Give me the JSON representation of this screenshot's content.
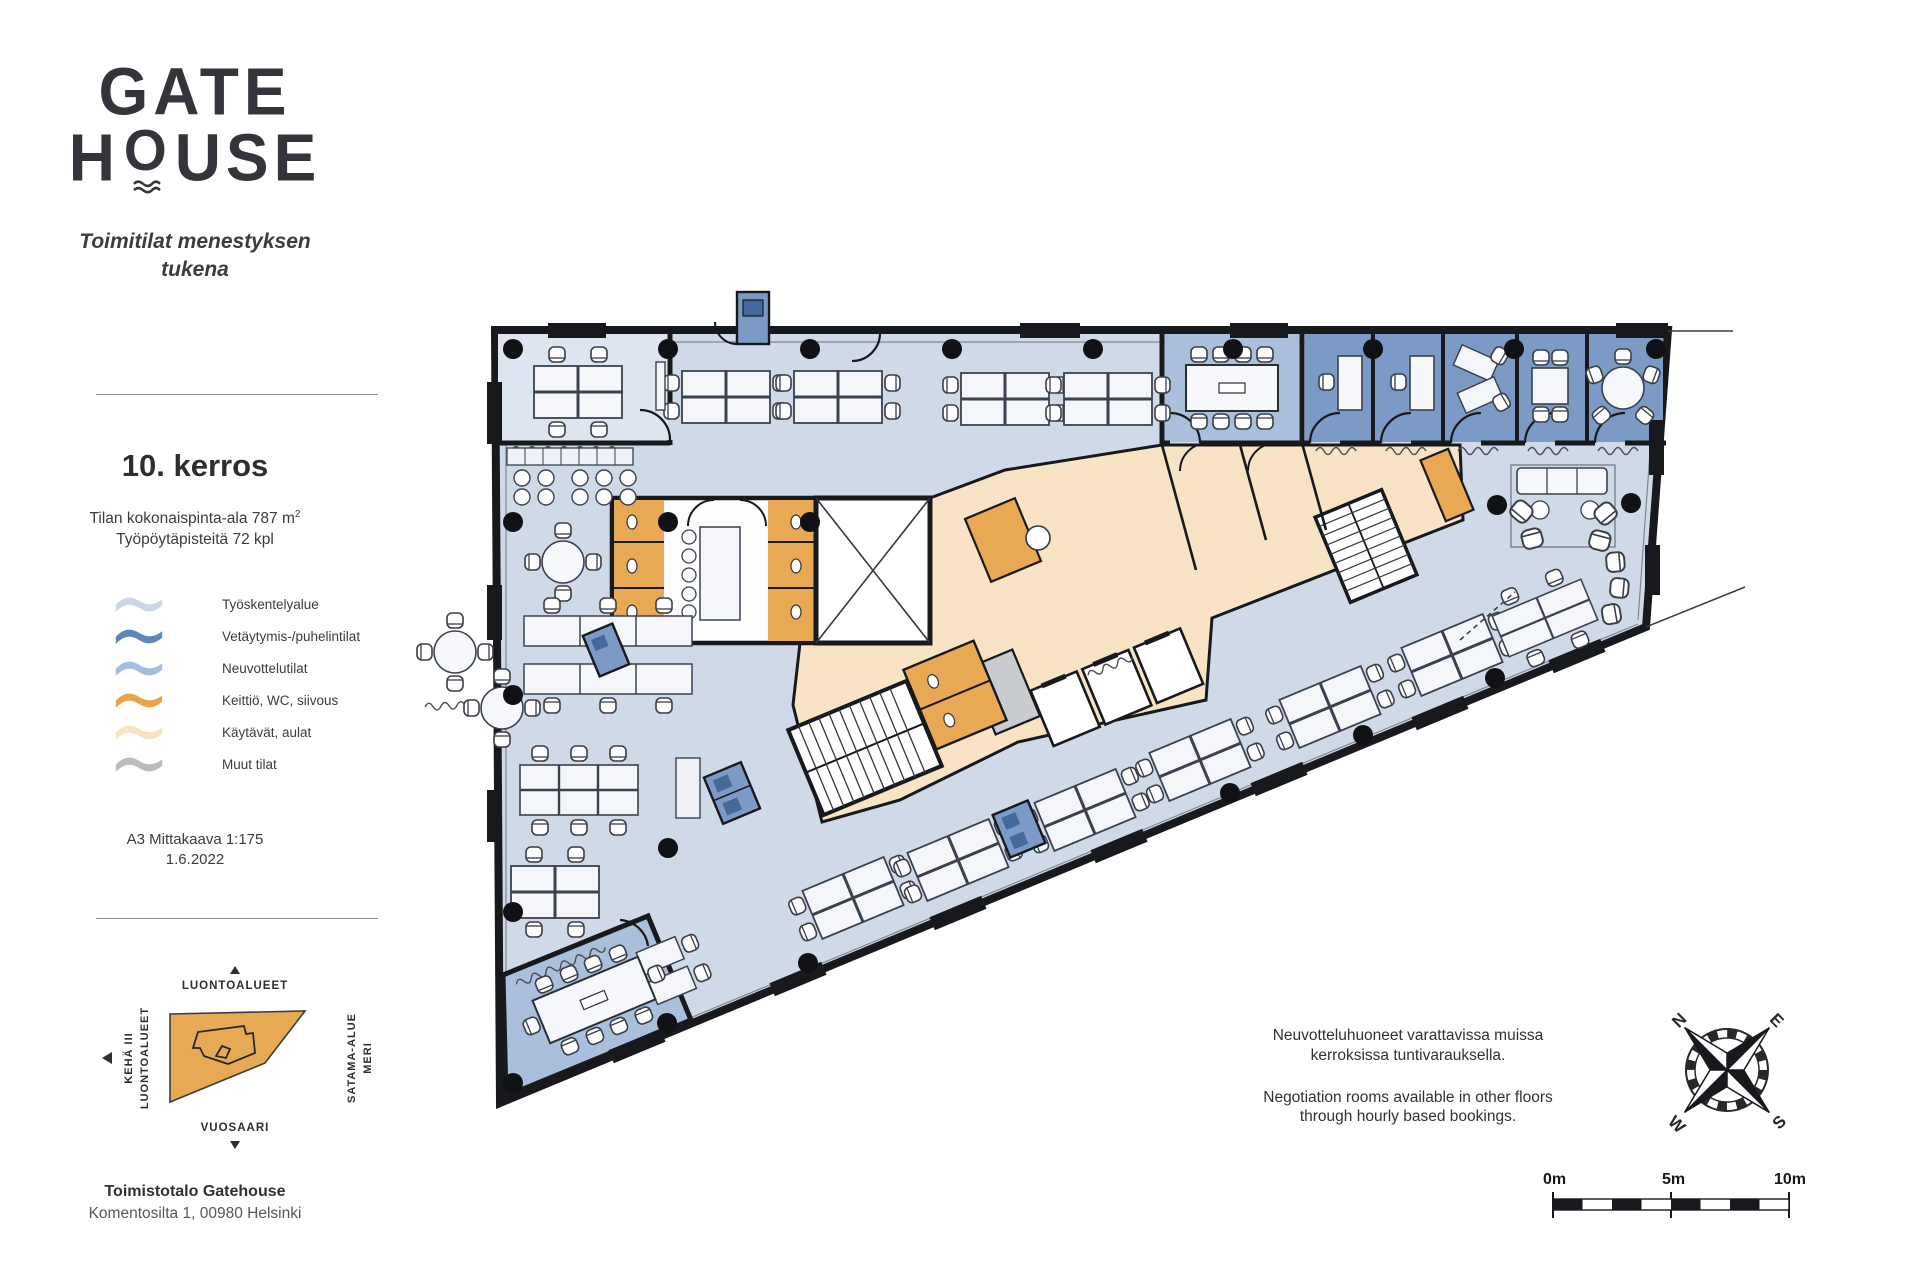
{
  "sidebar": {
    "logo": {
      "line1": "GATE",
      "line2_before_o": "H",
      "line2_o": "O",
      "line2_after_o": "USE"
    },
    "tagline_line1": "Toimitilat menestyksen",
    "tagline_line2": "tukena",
    "floor_title": "10. kerros",
    "area_text": "Tilan kokonaispinta-ala 787 m",
    "area_sup": "2",
    "desks_text": "Työpöytäpisteitä 72 kpl",
    "legend": [
      {
        "label": "Työskentelyalue",
        "color": "#ccd6e4"
      },
      {
        "label": "Vetäytymis-/puhelintilat",
        "color": "#5e86b8"
      },
      {
        "label": "Neuvottelutilat",
        "color": "#a3bedf"
      },
      {
        "label": "Keittiö, WC, siivous",
        "color": "#e7a44c"
      },
      {
        "label": "Käytävät, aulat",
        "color": "#f7e3c2"
      },
      {
        "label": "Muut tilat",
        "color": "#b9bcbe"
      }
    ],
    "scale_line1": "A3 Mittakaava 1:175",
    "scale_line2": "1.6.2022",
    "sitemap": {
      "top_label": "LUONTOALUEET",
      "left_label1": "KEHÄ III",
      "left_label2": "LUONTOALUEET",
      "right_label1": "MERI",
      "right_label2": "SATAMA-ALUE",
      "bottom_label": "VUOSAARI"
    },
    "address_line1": "Toimistotalo Gatehouse",
    "address_line2": "Komentosilta 1, 00980 Helsinki"
  },
  "notes": {
    "fi_line1": "Neuvotteluhuoneet varattavissa muissa",
    "fi_line2": "kerroksissa tuntivarauksella.",
    "en_line1": "Negotiation rooms available in other floors",
    "en_line2": "through hourly based bookings."
  },
  "compass": {
    "n": "N",
    "e": "E",
    "s": "S",
    "w": "W"
  },
  "scalebar": {
    "t0": "0m",
    "t5": "5m",
    "t10": "10m"
  },
  "colors": {
    "work": "#cfd9e7",
    "work_room": "#dde5f0",
    "meeting": "#a9bfdc",
    "retreat": "#7b9bc6",
    "booth_dark": "#44699b",
    "kitchen": "#e9a954",
    "corridor": "#f8e4c5",
    "other": "#c9cccf",
    "wall": "#17191c",
    "sitemap": "#e8a954"
  }
}
